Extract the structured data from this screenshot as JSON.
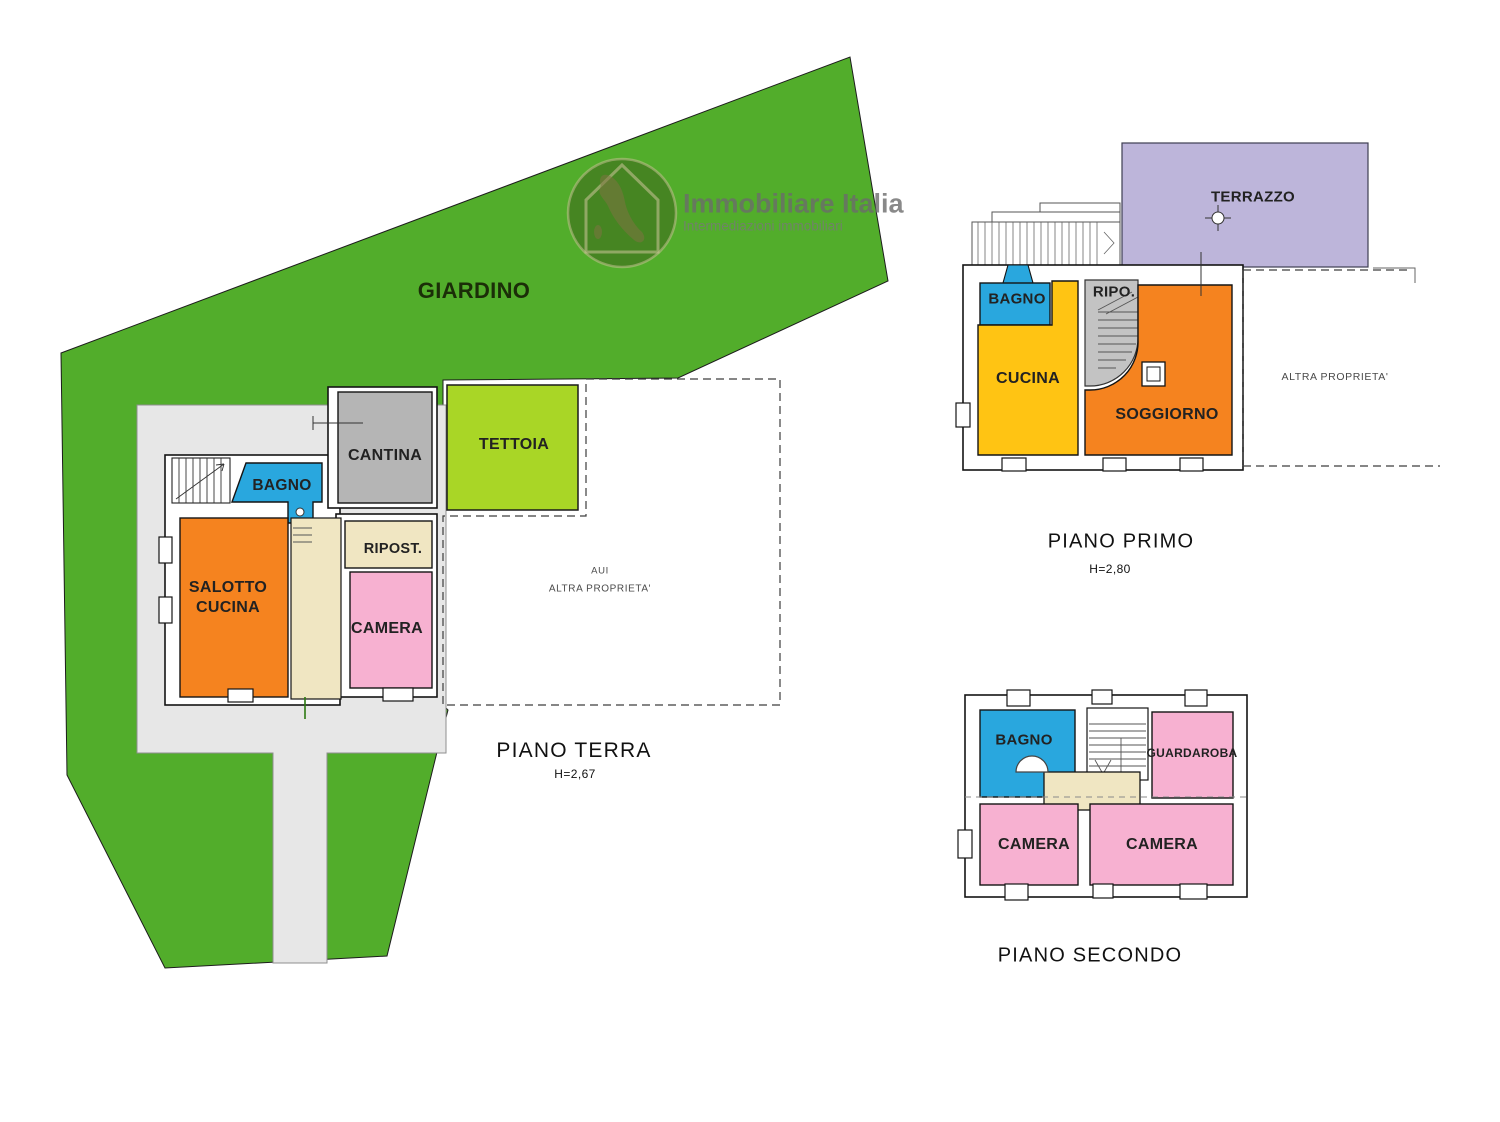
{
  "watermark": {
    "brand": "Immobiliare Italia",
    "tagline": "Intermediazioni immobiliari"
  },
  "garden": {
    "label": "GIARDINO"
  },
  "ground_floor": {
    "title": "PIANO TERRA",
    "height": "H=2,67",
    "rooms": {
      "cantina": "CANTINA",
      "tettoia": "TETTOIA",
      "bagno": "BAGNO",
      "salotto_line1": "SALOTTO",
      "salotto_line2": "CUCINA",
      "ripostiglio": "RIPOST.",
      "camera": "CAMERA"
    },
    "other_property_line1": "AUI",
    "other_property_line2": "ALTRA PROPRIETA'"
  },
  "first_floor": {
    "title": "PIANO PRIMO",
    "height": "H=2,80",
    "rooms": {
      "terrazzo": "TERRAZZO",
      "bagno": "BAGNO",
      "ripostiglio": "RIPO.",
      "cucina": "CUCINA",
      "soggiorno": "SOGGIORNO"
    },
    "other_property": "ALTRA PROPRIETA'"
  },
  "second_floor": {
    "title": "PIANO SECONDO",
    "rooms": {
      "bagno": "BAGNO",
      "guardaroba": "GUARDAROBA",
      "camera_left": "CAMERA",
      "camera_right": "CAMERA"
    }
  },
  "colors": {
    "garden": "#52ad2b",
    "tettoia": "#a9d626",
    "courtyard": "#e7e7e7",
    "room_orange": "#f5831f",
    "room_blue": "#29a7de",
    "room_pink": "#f7b1d1",
    "room_yellow": "#ffc413",
    "room_gray": "#b5b5b5",
    "stair_gray": "#c3c3c3",
    "hall_beige": "#f0e6c2",
    "terrace_lavender": "#bdb5da"
  }
}
